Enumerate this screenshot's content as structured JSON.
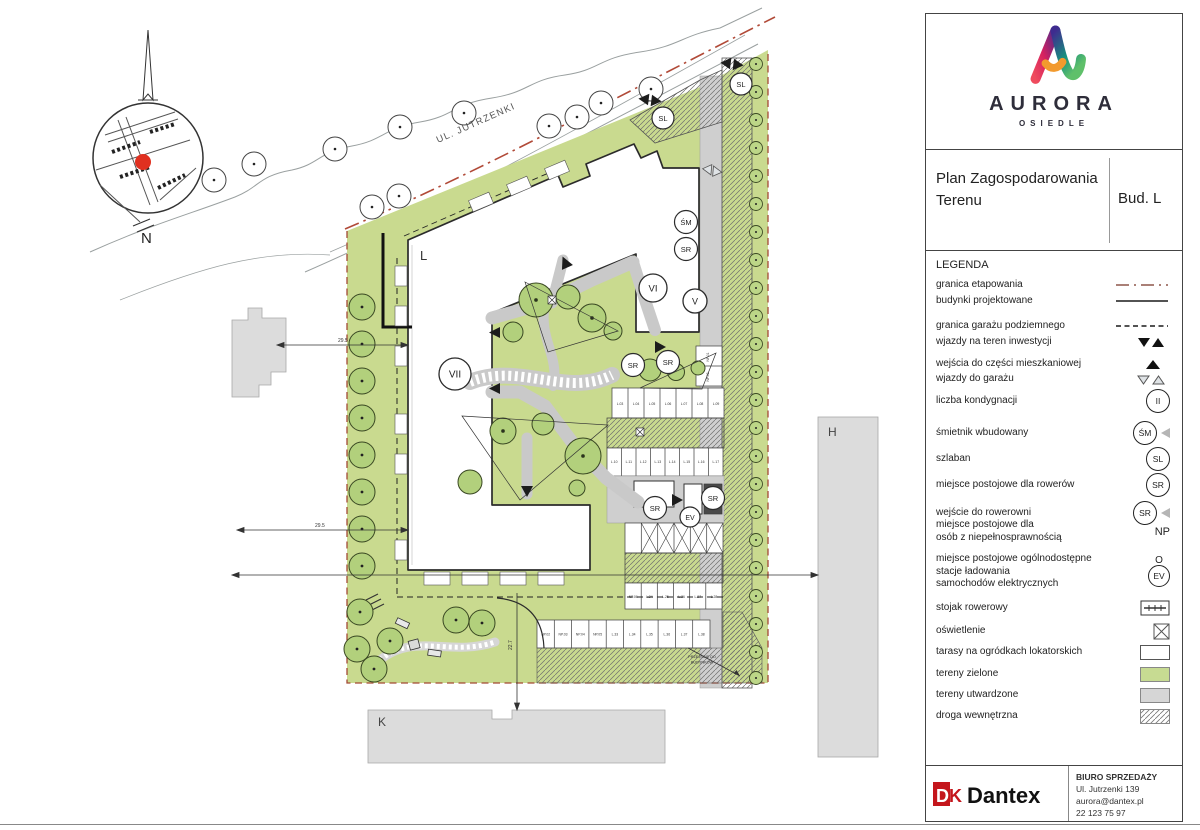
{
  "plan": {
    "north": "N",
    "street": "UL. JUTRZENKI",
    "labels": {
      "proposed_building": "L",
      "existing_building_right": "H",
      "existing_building_bottom": "K"
    },
    "storeys": {
      "vii": "VII",
      "vi": "VI",
      "v": "V"
    },
    "symbols": {
      "sm": "ŚM",
      "sl": "SL",
      "sr": "SR",
      "ev": "EV"
    },
    "dimensions": {
      "top": "29.5",
      "bottom": "29.5",
      "vertical": "22.7"
    },
    "note_line1": "PRZEJŚCIE DO",
    "note_line2": "BUDYNKÓW",
    "parking": {
      "np_pair": [
        "NP.01",
        "NP.02"
      ],
      "row1": [
        "L.03",
        "L.04",
        "L.05",
        "L.06",
        "L.07",
        "L.08",
        "L.09"
      ],
      "row2": [
        "L.10",
        "L.11",
        "L.12",
        "L.13",
        "L.14",
        "L.15",
        "L.16",
        "L.17"
      ],
      "row3": [
        "NP.06",
        "L.24",
        "L.25",
        "L.26",
        "L.27",
        "L.28"
      ],
      "row4": [
        "NP.02",
        "NP.03",
        "NP.04",
        "NP.05",
        "L.33",
        "L.34",
        "L.35",
        "L.36",
        "L.37",
        "L.38"
      ]
    }
  },
  "titleblock": {
    "brand": {
      "name": "AURORA",
      "subtitle": "OSIEDLE"
    },
    "title": "Plan Zagospodarowania Terenu",
    "building_ref": "Bud. L",
    "legend": {
      "heading": "LEGENDA",
      "items": [
        {
          "label": "granica etapowania",
          "symbol": "dash-dot-line"
        },
        {
          "label": "budynki projektowane",
          "symbol": "solid-line"
        },
        {
          "label": "granica garażu podziemnego",
          "symbol": "dashed-line"
        },
        {
          "label": "wjazdy na teren inwestycji",
          "symbol": "filled-triangles"
        },
        {
          "label": "wejścia do części mieszkaniowej",
          "symbol": "filled-triangle-up"
        },
        {
          "label": "wjazdy do garażu",
          "symbol": "outline-triangles"
        },
        {
          "label": "liczba kondygnacji",
          "symbol": "circle",
          "badge": "II"
        },
        {
          "label": "śmietnik wbudowany",
          "symbol": "circle-pointer",
          "badge": "ŚM"
        },
        {
          "label": "szlaban",
          "symbol": "circle",
          "badge": "SL"
        },
        {
          "label": "miejsce postojowe dla rowerów",
          "symbol": "circle",
          "badge": "SR"
        },
        {
          "label": "wejście do rowerowni",
          "symbol": "circle-pointer",
          "badge": "SR"
        },
        {
          "label": "miejsce postojowe dla\nosób z niepełnosprawnością",
          "symbol": "text",
          "badge": "NP"
        },
        {
          "label": "miejsce postojowe ogólnodostępne\nstacje ładowania\nsamochodów elektrycznych",
          "symbol": "o-over-circle",
          "badge": "EV",
          "badge_prefix": "O"
        },
        {
          "label": "stojak rowerowy",
          "symbol": "bike-rack"
        },
        {
          "label": "oświetlenie",
          "symbol": "x-box"
        },
        {
          "label": "tarasy na ogródkach lokatorskich",
          "symbol": "white-swatch"
        },
        {
          "label": "tereny zielone",
          "symbol": "green-swatch"
        },
        {
          "label": "tereny utwardzone",
          "symbol": "gray-swatch"
        },
        {
          "label": "droga wewnętrzna",
          "symbol": "hatch-swatch"
        }
      ]
    }
  },
  "footer": {
    "company": "Dantex",
    "logo_mark_d": "D",
    "logo_mark_k": "K",
    "office": "BIURO SPRZEDAŻY",
    "address": "Ul. Jutrzenki 139",
    "email": "aurora@dantex.pl",
    "phone": "22 123 75 97"
  },
  "colors": {
    "site_green": "#c9da8f",
    "tree_green": "#b2d07c",
    "surface_gray": "#cfcfcf",
    "boundary_red": "#b14a38",
    "brand_red": "#c4161c"
  }
}
